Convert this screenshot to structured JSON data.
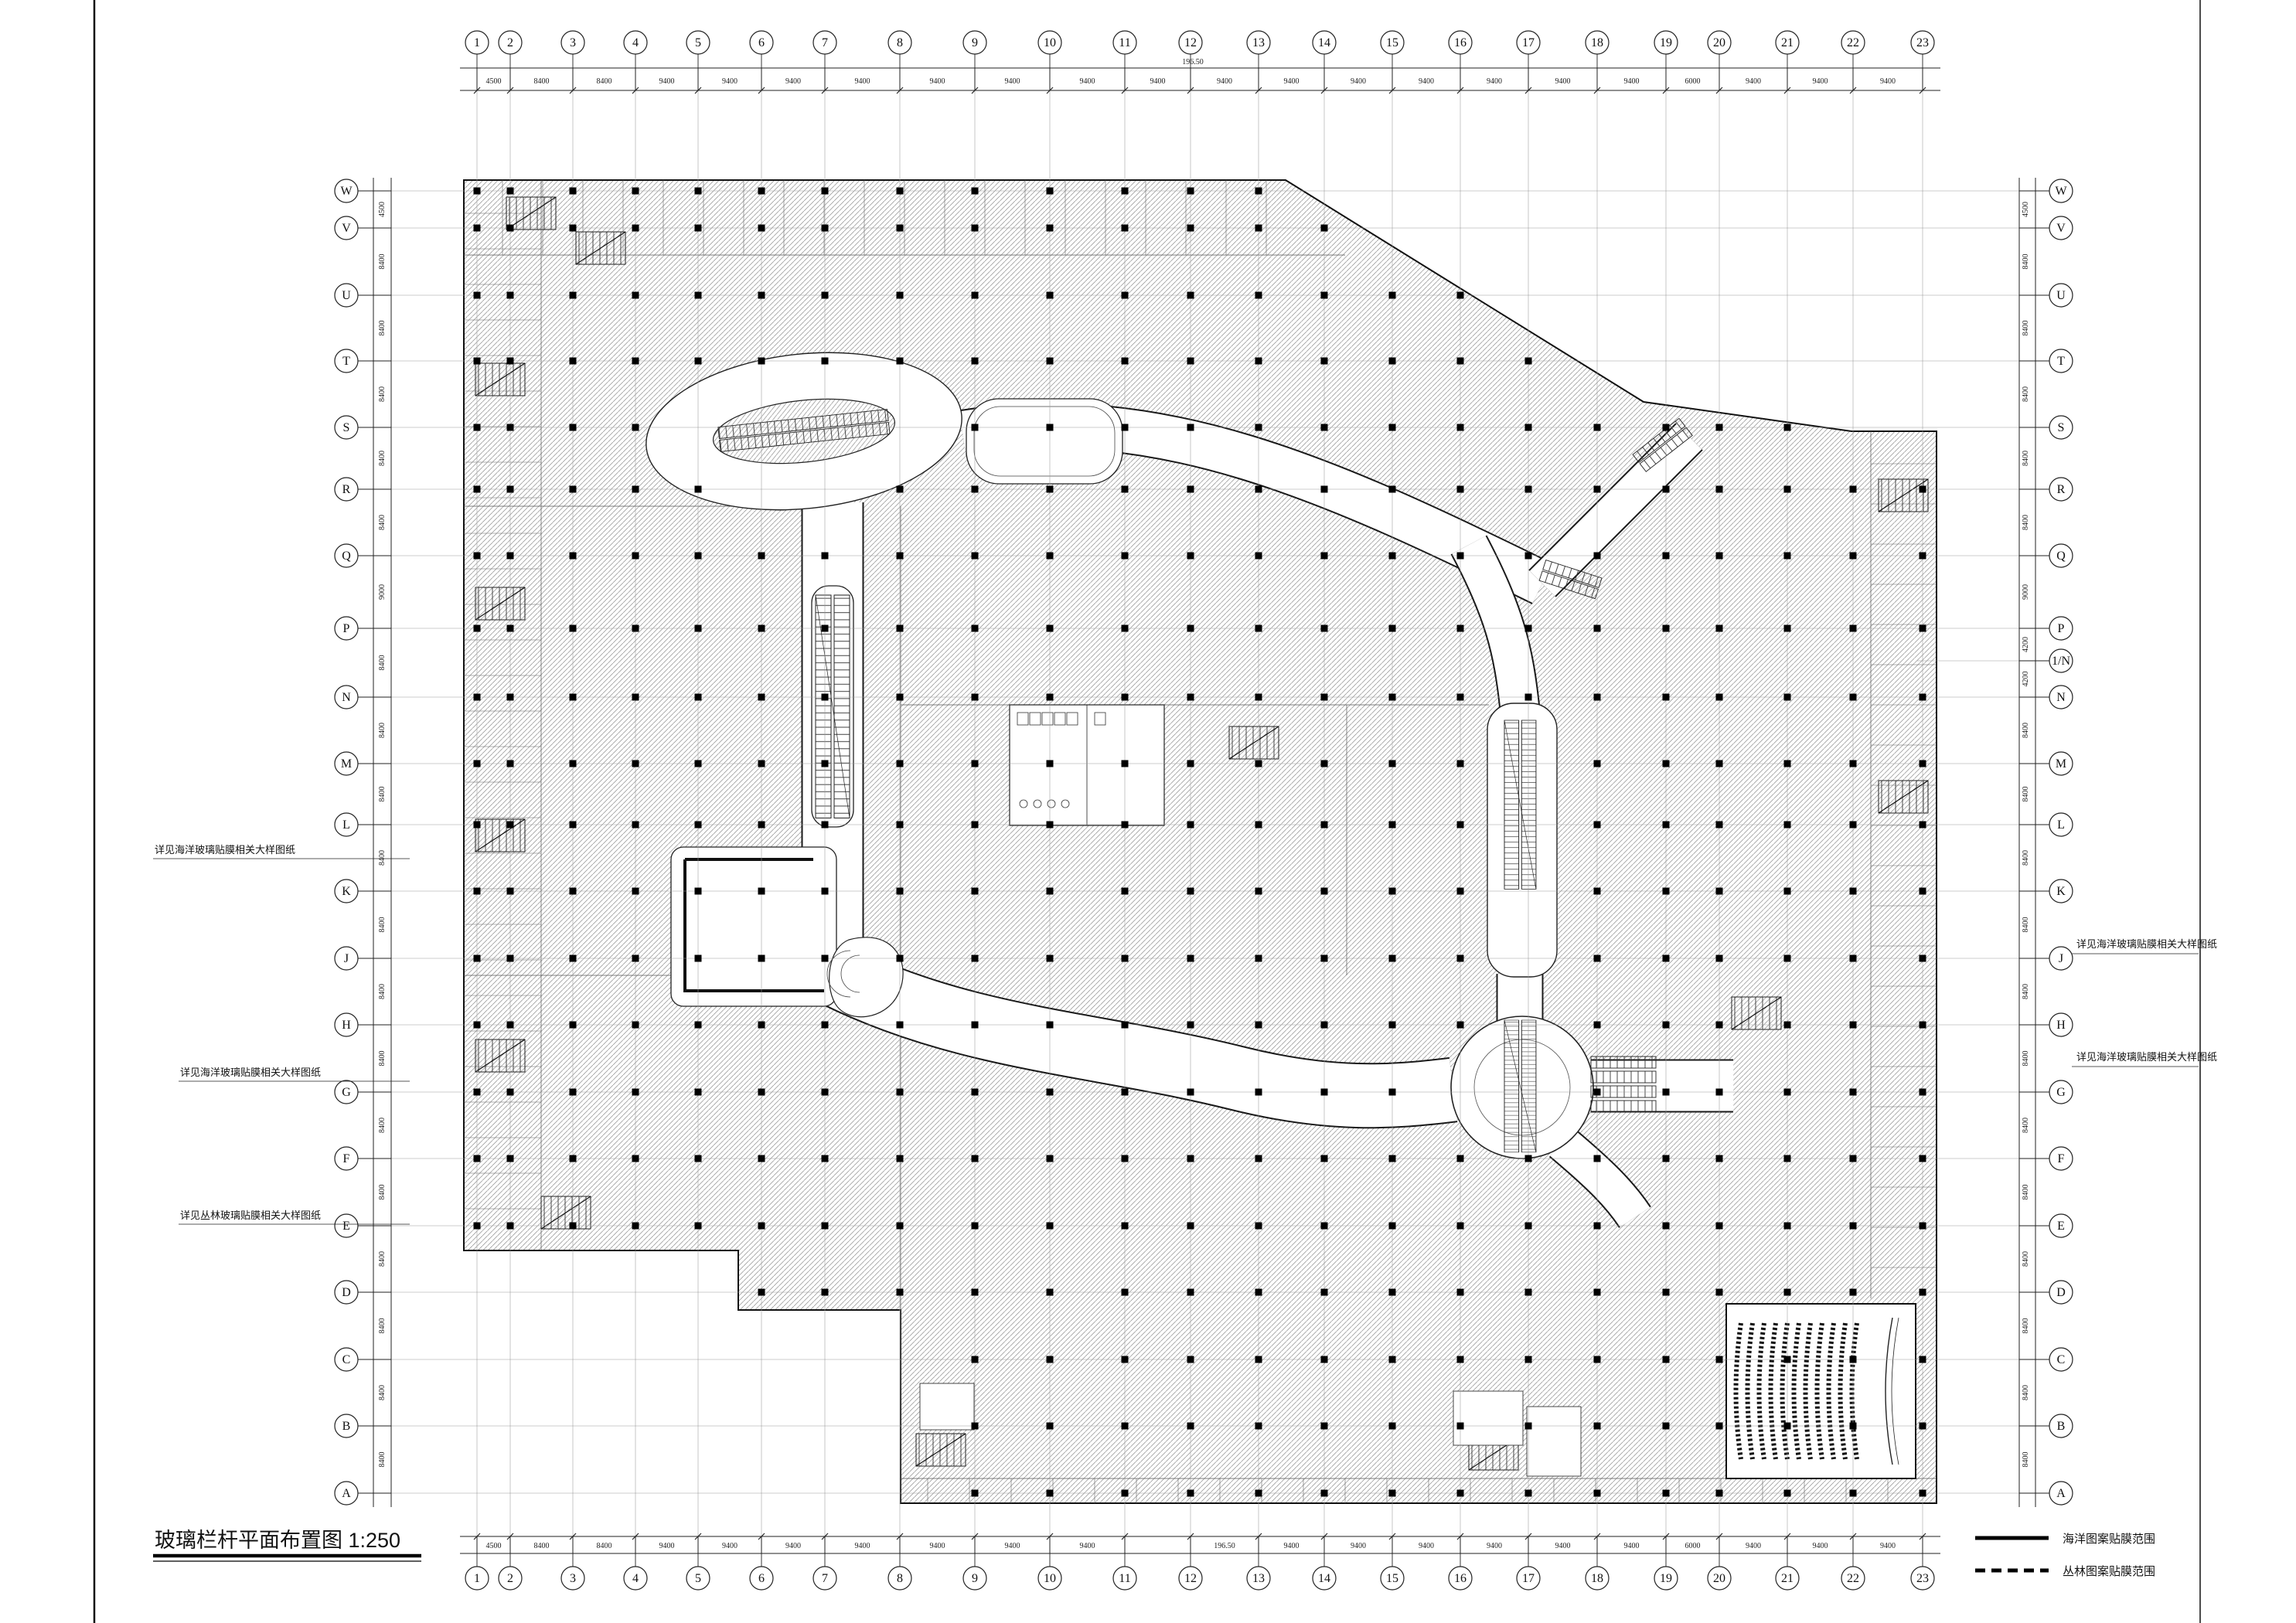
{
  "sheet": {
    "title": "玻璃栏杆平面布置图",
    "scale": "1:250",
    "title_full": "玻璃栏杆平面布置图 1:250"
  },
  "legend": {
    "items": [
      {
        "line_style": "solid",
        "label": "海洋图案贴膜范围"
      },
      {
        "line_style": "dashed",
        "label": "丛林图案贴膜范围"
      }
    ]
  },
  "grid": {
    "columns": [
      "1",
      "2",
      "3",
      "4",
      "5",
      "6",
      "7",
      "8",
      "9",
      "10",
      "11",
      "12",
      "13",
      "14",
      "15",
      "16",
      "17",
      "18",
      "19",
      "20",
      "21",
      "22",
      "23"
    ],
    "rows_left": [
      "W",
      "V",
      "U",
      "T",
      "S",
      "R",
      "Q",
      "P",
      "N",
      "M",
      "L",
      "K",
      "J",
      "H",
      "G",
      "F",
      "E",
      "D",
      "C",
      "B",
      "A"
    ],
    "rows_right": [
      "W",
      "V",
      "U",
      "T",
      "S",
      "R",
      "Q",
      "P",
      "1/N",
      "N",
      "M",
      "L",
      "K",
      "J",
      "H",
      "G",
      "F",
      "E",
      "D",
      "C",
      "B",
      "A"
    ],
    "top_dims": [
      "4500",
      "8400",
      "8400",
      "9400",
      "9400",
      "9400",
      "9400",
      "9400",
      "9400",
      "9400",
      "9400",
      "9400",
      "9400",
      "9400",
      "9400",
      "9400",
      "9400",
      "9400",
      "6000",
      "9400",
      "9400",
      "9400"
    ],
    "bottom_dims": [
      "4500",
      "8400",
      "8400",
      "9400",
      "9400",
      "9400",
      "9400",
      "9400",
      "9400",
      "9400",
      "9400",
      "9400",
      "9400",
      "9400",
      "9400",
      "9400",
      "9400",
      "9400",
      "6000",
      "9400",
      "9400",
      "9400"
    ],
    "left_dims": [
      "4500",
      "8400",
      "8400",
      "8400",
      "8400",
      "8400",
      "9000",
      "8400",
      "8400",
      "8400",
      "8400",
      "8400",
      "8400",
      "8400",
      "8400",
      "8400",
      "8400",
      "8400",
      "8400",
      "8400"
    ],
    "right_dims": [
      "4500",
      "8400",
      "8400",
      "8400",
      "8400",
      "8400",
      "9000",
      "4200",
      "4200",
      "8400",
      "8400",
      "8400",
      "8400",
      "8400",
      "8400",
      "8400",
      "8400",
      "8400",
      "8400",
      "8400",
      "8400"
    ],
    "overall_width_top": "196.50",
    "overall_width_bottom": "196.50"
  },
  "annotations": {
    "left": [
      "详见海洋玻璃贴膜相关大样图纸",
      "详见海洋玻璃贴膜相关大样图纸",
      "详见丛林玻璃贴膜相关大样图纸"
    ],
    "right": [
      "详见海洋玻璃贴膜相关大样图纸",
      "详见海洋玻璃贴膜相关大样图纸"
    ]
  }
}
